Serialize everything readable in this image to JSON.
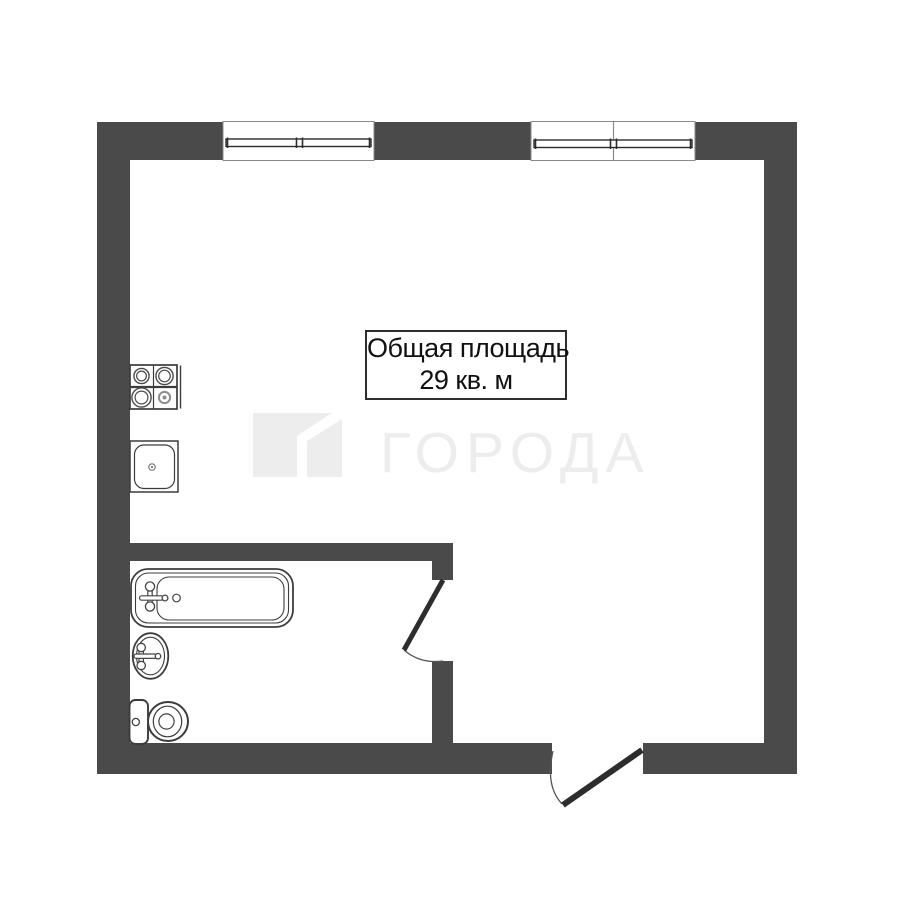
{
  "area_label": {
    "line1": "Общая площадь",
    "line2": "29 кв. м"
  },
  "watermark": {
    "text": "ГОРОДА",
    "logo": "flag-logo"
  },
  "colors": {
    "wall": "#4A4A4A",
    "fixture_outline": "#3C3C3C",
    "door_leaf": "#2D2D2D",
    "watermark": "#EDEDED",
    "label_text": "#111111",
    "background": "#FFFFFF"
  },
  "fixtures": [
    "stove",
    "kitchen-sink",
    "bathtub",
    "washbasin",
    "toilet"
  ],
  "windows": [
    "window-left",
    "window-right"
  ],
  "doors": [
    "bathroom-door",
    "entrance-door"
  ]
}
